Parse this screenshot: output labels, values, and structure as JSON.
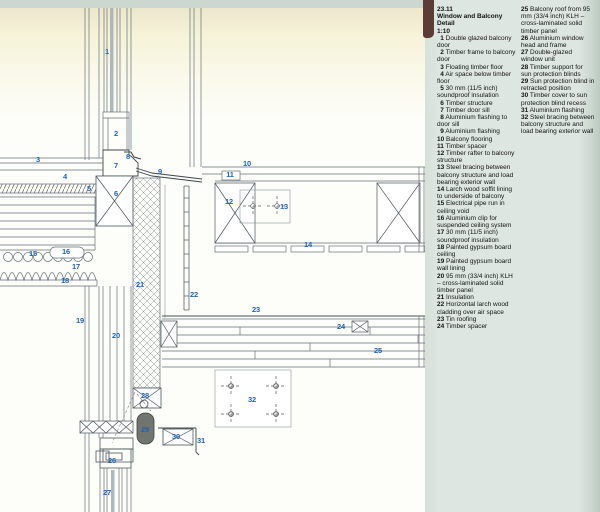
{
  "header": {
    "code": "23.11",
    "title": "Window and Balcony Detail",
    "scale": "1:10"
  },
  "legend_items": [
    {
      "num": "1",
      "text": "Double glazed balcony door"
    },
    {
      "num": "2",
      "text": "Timber frame to balcony door"
    },
    {
      "num": "3",
      "text": "Floating timber floor"
    },
    {
      "num": "4",
      "text": "Air space below timber floor"
    },
    {
      "num": "5",
      "text": "30 mm (11/5 inch) soundproof insulation"
    },
    {
      "num": "6",
      "text": "Timber structure"
    },
    {
      "num": "7",
      "text": "Timber door sill"
    },
    {
      "num": "8",
      "text": "Aluminium flashing to door sill"
    },
    {
      "num": "9",
      "text": "Aluminium flashing"
    },
    {
      "num": "10",
      "text": "Balcony flooring"
    },
    {
      "num": "11",
      "text": "Timber spacer"
    },
    {
      "num": "12",
      "text": "Timber rafter to balcony structure"
    },
    {
      "num": "13",
      "text": "Steel bracing between balcony structure and load bearing exterior wall"
    },
    {
      "num": "14",
      "text": "Larch wood soffit lining to underside of balcony"
    },
    {
      "num": "15",
      "text": "Electrical pipe run in ceiling void"
    },
    {
      "num": "16",
      "text": "Aluminium clip for suspended ceiling system"
    },
    {
      "num": "17",
      "text": "30 mm (11/5 inch) soundproof insulation"
    },
    {
      "num": "18",
      "text": "Painted gypsum board ceiling"
    },
    {
      "num": "19",
      "text": "Painted gypsum board wall lining"
    },
    {
      "num": "20",
      "text": "95 mm (33/4 inch) KLH – cross-laminated solid timber panel"
    },
    {
      "num": "21",
      "text": "Insulation"
    },
    {
      "num": "22",
      "text": "Horizontal larch wood cladding over air space"
    },
    {
      "num": "23",
      "text": "Tin roofing"
    },
    {
      "num": "24",
      "text": "Timber spacer"
    },
    {
      "num": "25",
      "text": "Balcony roof from 95 mm (33/4 inch) KLH – cross-laminated solid timber panel"
    },
    {
      "num": "26",
      "text": "Aluminium window head and frame"
    },
    {
      "num": "27",
      "text": "Double-glazed window unit"
    },
    {
      "num": "28",
      "text": "Timber support for sun protection blinds"
    },
    {
      "num": "29",
      "text": "Sun protection blind in retracted position"
    },
    {
      "num": "30",
      "text": "Timber cover to sun protection blind recess"
    },
    {
      "num": "31",
      "text": "Aluminium flashing"
    },
    {
      "num": "32",
      "text": "Steel bracing between balcony structure and load bearing exterior wall"
    }
  ],
  "legend_column_split": 24,
  "drawing": {
    "callouts": [
      {
        "n": "1",
        "x": 107,
        "y": 52
      },
      {
        "n": "2",
        "x": 116,
        "y": 134
      },
      {
        "n": "3",
        "x": 38,
        "y": 160
      },
      {
        "n": "4",
        "x": 65,
        "y": 177
      },
      {
        "n": "5",
        "x": 89,
        "y": 189
      },
      {
        "n": "6",
        "x": 116,
        "y": 194
      },
      {
        "n": "7",
        "x": 116,
        "y": 166
      },
      {
        "n": "8",
        "x": 128,
        "y": 157
      },
      {
        "n": "9",
        "x": 160,
        "y": 172
      },
      {
        "n": "10",
        "x": 247,
        "y": 164
      },
      {
        "n": "11",
        "x": 230,
        "y": 175
      },
      {
        "n": "12",
        "x": 229,
        "y": 202
      },
      {
        "n": "13",
        "x": 284,
        "y": 207
      },
      {
        "n": "14",
        "x": 308,
        "y": 245
      },
      {
        "n": "15",
        "x": 33,
        "y": 254
      },
      {
        "n": "16",
        "x": 66,
        "y": 252
      },
      {
        "n": "17",
        "x": 76,
        "y": 267
      },
      {
        "n": "18",
        "x": 65,
        "y": 281
      },
      {
        "n": "19",
        "x": 80,
        "y": 321
      },
      {
        "n": "20",
        "x": 116,
        "y": 336
      },
      {
        "n": "21",
        "x": 140,
        "y": 285
      },
      {
        "n": "22",
        "x": 194,
        "y": 295
      },
      {
        "n": "23",
        "x": 256,
        "y": 310
      },
      {
        "n": "24",
        "x": 341,
        "y": 327
      },
      {
        "n": "25",
        "x": 378,
        "y": 351
      },
      {
        "n": "26",
        "x": 112,
        "y": 461
      },
      {
        "n": "27",
        "x": 107,
        "y": 493
      },
      {
        "n": "28",
        "x": 145,
        "y": 396
      },
      {
        "n": "29",
        "x": 145,
        "y": 430
      },
      {
        "n": "30",
        "x": 176,
        "y": 437
      },
      {
        "n": "31",
        "x": 201,
        "y": 441
      },
      {
        "n": "32",
        "x": 252,
        "y": 400
      }
    ]
  },
  "colors": {
    "callout_blue": "#1e63b4",
    "legend_background": "#dde6e0",
    "cream_band": "#f6f3d9",
    "line_grey": "#66727a",
    "blind_grey": "#70766f"
  }
}
